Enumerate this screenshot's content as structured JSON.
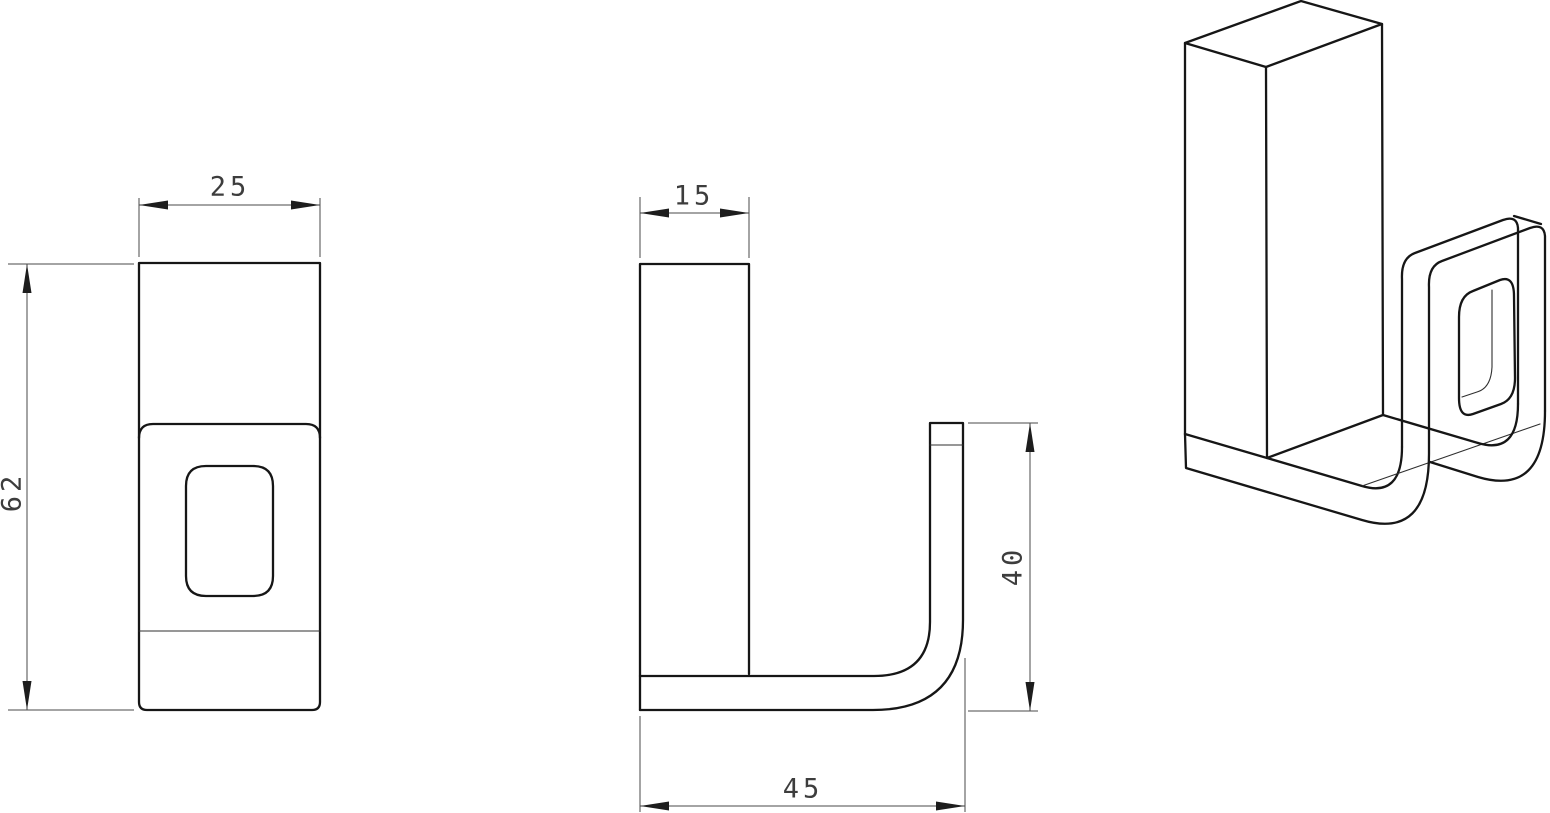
{
  "colors": {
    "background": "#ffffff",
    "object_line": "#161616",
    "thin_edge_line": "#2f2f2f",
    "dimension_line": "#4a4a4a",
    "dimension_text": "#3d3d3d"
  },
  "drawing": {
    "views": {
      "front": {
        "dimensions": {
          "width": "25",
          "height": "62"
        }
      },
      "side": {
        "dimensions": {
          "thickness": "15",
          "hook_height": "40",
          "depth": "45"
        }
      },
      "isometric": {
        "dimensions": {}
      }
    }
  }
}
